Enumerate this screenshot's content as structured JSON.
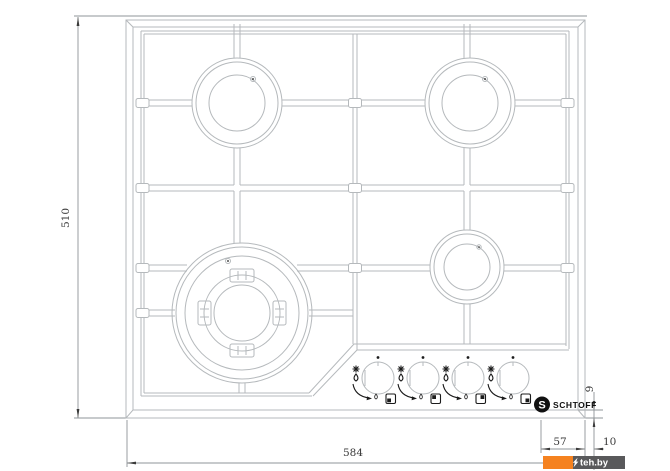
{
  "title": "Gas hob technical drawing (top view)",
  "dimensions": {
    "height": "510",
    "width": "584",
    "panel": "57",
    "offset": "10",
    "lip": "9"
  },
  "brand": {
    "logo_letter": "S",
    "name": "SCHTOFF"
  },
  "watermark": {
    "text": "teh.by"
  },
  "colors": {
    "line": "#b5b9bc",
    "dim": "#8f9498",
    "ink": "#3a3a3a",
    "symbol": "#1b1b1b",
    "orange": "#f58220",
    "bar": "#59595b"
  },
  "burners": [
    {
      "id": "rear-left",
      "size": "standard"
    },
    {
      "id": "rear-right",
      "size": "standard"
    },
    {
      "id": "front-left",
      "size": "wok-large"
    },
    {
      "id": "front-right",
      "size": "auxiliary"
    }
  ],
  "controls": {
    "knobs": [
      {
        "id": "1",
        "burner": "front-left",
        "indicator_corner": "bl"
      },
      {
        "id": "2",
        "burner": "rear-left",
        "indicator_corner": "tl"
      },
      {
        "id": "3",
        "burner": "rear-right",
        "indicator_corner": "tr"
      },
      {
        "id": "4",
        "burner": "front-right",
        "indicator_corner": "br"
      }
    ]
  }
}
